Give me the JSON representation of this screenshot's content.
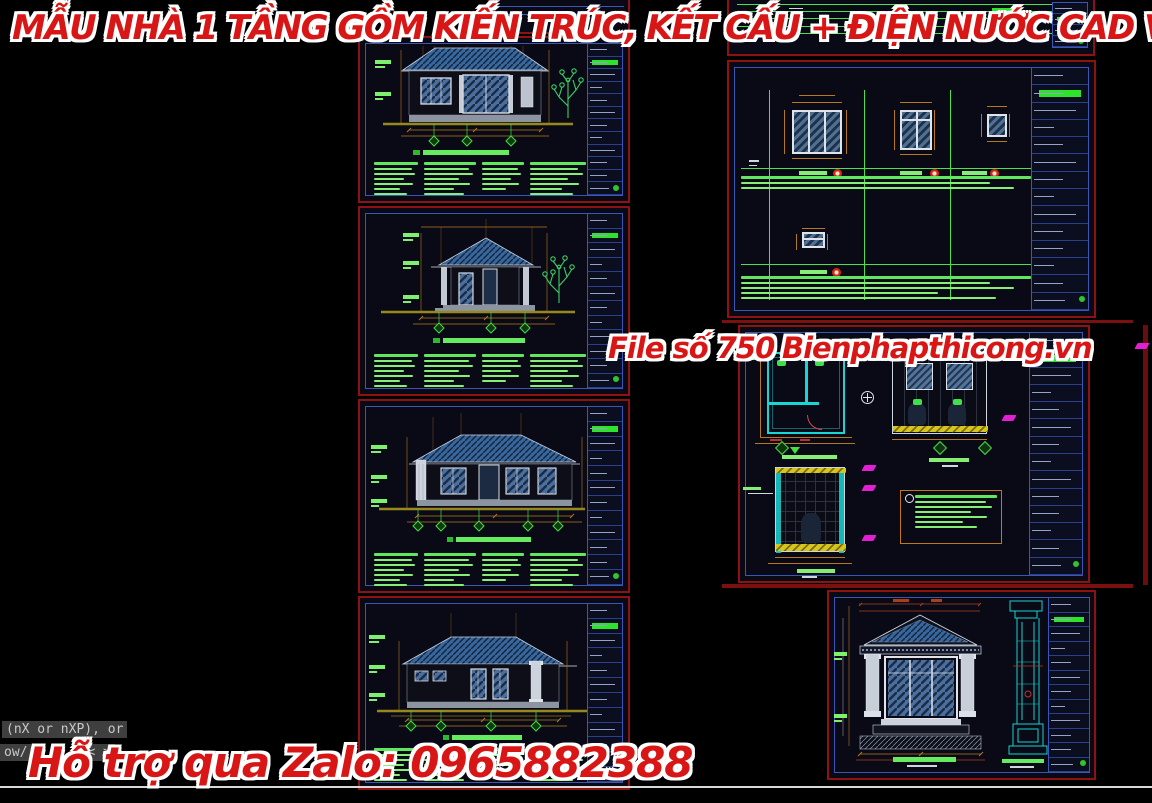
{
  "title_banner": "MẪU NHÀ 1 TẦNG GỒM KIẾN TRÚC, KẾT CẤU + ĐIỆN NƯỚC CAD VÀ PDF",
  "watermarks": {
    "file_label": "File số 750",
    "website": "Bienphapthicong.vn",
    "support": "Hỗ trợ qua Zalo: 0965882388"
  },
  "command_line": {
    "line1": "(nX or nXP), or",
    "line2_start": "ow/",
    "line2_rest": "<  >"
  },
  "colors": {
    "background": "#000000",
    "accent_red": "#d81616",
    "sheet_border": "#8f1212",
    "cad_green": "#84ef74",
    "highlight_green": "#2ee32b",
    "dim_orange": "#b5791c",
    "roof_blue": "#36679e",
    "cyan": "#19d6d6",
    "magenta": "#e21fd3",
    "yellow": "#d6c51c"
  }
}
